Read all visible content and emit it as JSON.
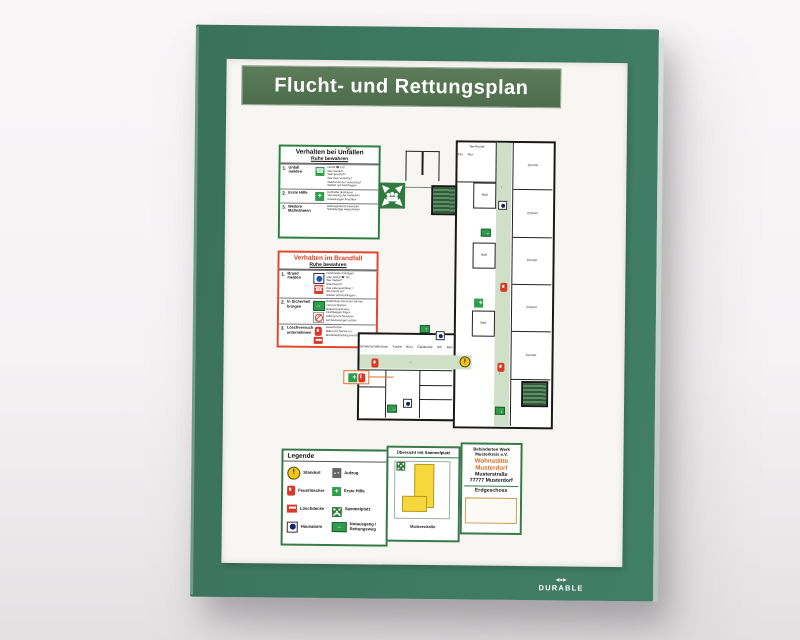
{
  "brand": {
    "name": "DURABLE"
  },
  "title": "Flucht- und Rettungsplan",
  "accident_panel": {
    "title": "Verhalten bei Unfällen",
    "subtitle": "Ruhe bewahren",
    "rows": [
      {
        "num": "1.",
        "label": "Unfall melden",
        "icon": "phone-icon",
        "note": "Notruf ☎ 112\nWer meldet?\nWas geschah?\nWie viele Verletzte?\nWelche Art der Verletzung?\nWarten auf Rückfragen!"
      },
      {
        "num": "2.",
        "label": "Erste Hilfe",
        "icon": "first-aid-icon",
        "note": "Ersthelfer alarmieren\nVersorgung der Verletzten\nAnweisungen beachten"
      },
      {
        "num": "3.",
        "label": "Weitere Maßnahmen",
        "icon": "",
        "note": "Rettungsdienst einweisen\nSchaulustige wegschicken"
      }
    ]
  },
  "fire_panel": {
    "title": "Verhalten im Brandfall",
    "subtitle": "Ruhe bewahren",
    "rows": [
      {
        "num": "1.",
        "label": "Brand melden",
        "icons": [
          "fire-alarm-button-icon",
          "phone-icon"
        ],
        "note": "Handmelder betätigen\noder Notruf ☎ 112\nWer meldet?\nWas brennt?\nWie viele Betroffene?\nWo brennt es?\nWarten auf Rückfragen!"
      },
      {
        "num": "2.",
        "label": "In Sicherheit bringen",
        "icons": [
          "emergency-exit-icon",
          "no-elevator-icon"
        ],
        "note": "Gefährdete Personen warnen\nTüren schließen\nGekennzeichneten\nFluchtwegen folgen\nAufzug nicht benutzen\nAuf Anweisungen achten"
      },
      {
        "num": "3.",
        "label": "Löschversuch unternehmen",
        "icons": [
          "fire-extinguisher-icon",
          "fire-blanket-icon"
        ],
        "note": "Feuerlöscher\nMittel und Geräte zur\nBrandbekämpfung benutzen"
      }
    ]
  },
  "plan": {
    "rooms": {
      "tee_kueche": "Tee-Küche",
      "zimmer": "Zimmer",
      "bad": "Bad",
      "flur": "Flur",
      "gemeinschaftsraum": "Gemeinschaftsraum",
      "kueche": "Küche",
      "buero": "Büro",
      "garderobe": "Garderobe",
      "wc": "WC",
      "beh_wc": "Beh. WC",
      "umkleiden": "Umkleiden"
    }
  },
  "legend": {
    "title": "Legende",
    "items": [
      {
        "label": "Standort",
        "icon": "location-icon"
      },
      {
        "label": "Feuerlöscher",
        "icon": "fire-extinguisher-icon"
      },
      {
        "label": "Löschdecke",
        "icon": "fire-blanket-icon"
      },
      {
        "label": "Hausalarm",
        "icon": "house-alarm-icon"
      },
      {
        "label": "Aufzug",
        "icon": "elevator-icon"
      },
      {
        "label": "Erste Hilfe",
        "icon": "first-aid-icon"
      },
      {
        "label": "Sammelplatz",
        "icon": "assembly-point-icon"
      },
      {
        "label": "Notausgang /\nRettungsweg",
        "icon": "emergency-exit-icon"
      }
    ]
  },
  "overview": {
    "title": "Übersicht mit Sammelplatz",
    "street": "Musterstraße"
  },
  "address": {
    "org_line1": "Behinderten Werk",
    "org_line2": "Musterkreis e.V.",
    "facility": "Wohnstätte",
    "facility_city": "Musterdorf",
    "street": "Musterstraße",
    "zip_city": "77777 Musterdorf",
    "floor": "Erdgeschoss"
  },
  "icons": {
    "phone": "☎",
    "cross": "+",
    "up": "↑",
    "down": "↓",
    "left": "←",
    "right": "→",
    "exclaim": "!",
    "elevator": "▲▼"
  },
  "colors": {
    "frame_green": "#3e7863",
    "banner_green": "#53724f",
    "signal_red": "#d93a28",
    "exit_green": "#2f9e4c",
    "route_green": "#cfdfc8",
    "stair_green": "#2e5c3a",
    "standort_yellow": "#f2c51d",
    "accent_orange": "#d96a1e",
    "panel_border_green": "#2e8040",
    "panel_border_red": "#e0492f"
  }
}
